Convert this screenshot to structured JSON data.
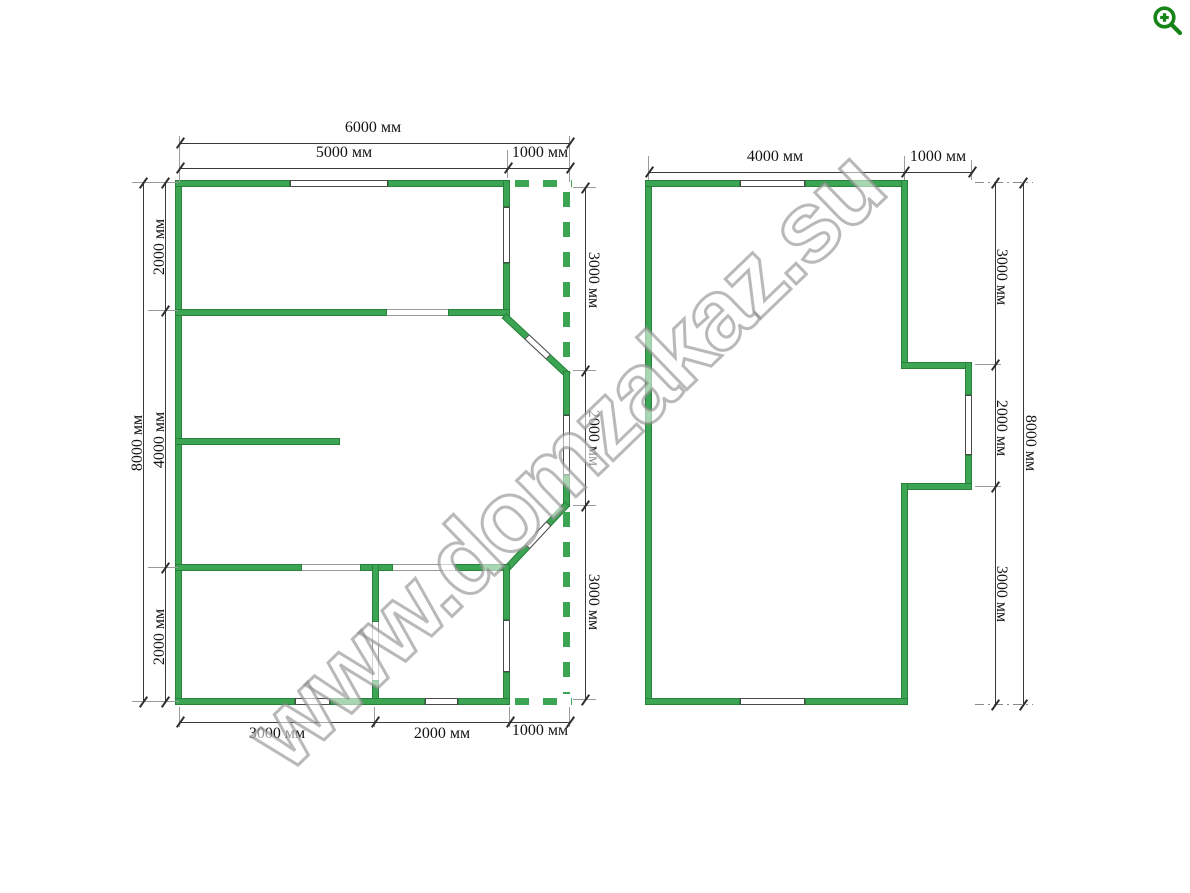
{
  "watermark": {
    "text": "www.domzakaz.su"
  },
  "icons": {
    "zoom_icon": "magnifier-plus"
  },
  "colors": {
    "wall": "#3CA553",
    "wall_border": "#27813A",
    "dim_line": "#3A3A3A",
    "icon_green": "#168416"
  },
  "plan_left": {
    "dims": {
      "top_total": "6000 мм",
      "top_main": "5000 мм",
      "top_right": "1000 мм",
      "left_total": "8000 мм",
      "left_top": "2000 мм",
      "left_mid": "4000 мм",
      "left_bottom": "2000 мм",
      "right_top": "3000 мм",
      "right_mid": "2000 мм",
      "right_bottom": "3000 мм",
      "bottom_left": "3000 мм",
      "bottom_mid": "2000 мм",
      "bottom_right": "1000 мм"
    }
  },
  "plan_right": {
    "dims": {
      "top_main": "4000 мм",
      "top_right": "1000 мм",
      "right_top": "3000 мм",
      "right_mid": "2000 мм",
      "right_bottom": "3000 мм",
      "right_total": "8000 мм"
    }
  }
}
